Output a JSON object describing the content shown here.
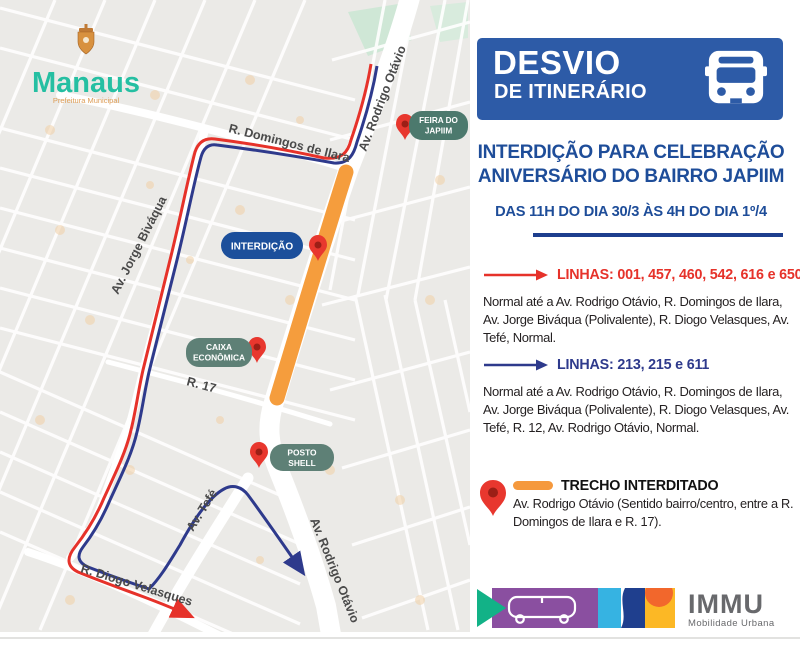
{
  "map": {
    "logo": {
      "title": "Manaus",
      "subtitle": "Prefeitura Municipal"
    },
    "streets": {
      "domingos": "R. Domingos de Ilara",
      "rodrigo_top": "Av. Rodrigo Otávio",
      "rodrigo_bottom": "Av. Rodrigo Otávio",
      "jorge": "Av. Jorge Biváqua",
      "r17": "R. 17",
      "tefe": "Av. Tefé",
      "diogo": "R. Diogo Velasques"
    },
    "badges": {
      "feira": {
        "line1": "FEIRA DO",
        "line2": "JAPIIM"
      },
      "interdicao": {
        "line1": "INTERDIÇÃO"
      },
      "caixa": {
        "line1": "CAIXA",
        "line2": "ECONÔMICA"
      },
      "posto": {
        "line1": "POSTO",
        "line2": "SHELL"
      }
    },
    "icons": {
      "pin": "map-pin-icon"
    }
  },
  "panel": {
    "header": {
      "title": "DESVIO",
      "subtitle": "DE ITINERÁRIO",
      "icon": "bus-front-icon"
    },
    "headline": {
      "line1": "INTERDIÇÃO PARA CELEBRAÇÃO",
      "line2": "ANIVERSÁRIO DO BAIRRO JAPIIM"
    },
    "schedule": "DAS 11H DO DIA 30/3 ÀS 4H DO DIA 1º/4",
    "routes": [
      {
        "label": "LINHAS: 001, 457, 460, 542, 616 e 650",
        "description": "Normal até a Av. Rodrigo Otávio, R. Domingos de Ilara, Av. Jorge Biváqua (Polivalente), R. Diogo Velasques, Av. Tefé, Normal.",
        "color": "#e6322a"
      },
      {
        "label": "LINHAS:  213, 215 e 611",
        "description": "Normal até a Av. Rodrigo Otávio, R. Domingos de Ilara, Av. Jorge Biváqua (Polivalente), R. Diogo Velasques, Av. Tefé, R. 12, Av. Rodrigo Otávio, Normal.",
        "color": "#2e3a8c"
      }
    ],
    "blocked": {
      "title": "TRECHO INTERDITADO",
      "description": "Av. Rodrigo Otávio (Sentido bairro/centro, entre a R. Domingos de Ilara e R. 17)."
    },
    "footer": {
      "brand": "IMMU",
      "tagline": "Mobilidade Urbana",
      "icon": "bus-side-icon"
    }
  },
  "colors": {
    "header_blue": "#2d5ba7",
    "headline_blue": "#1e4d99",
    "divider_navy": "#1d3e8e",
    "route_red": "#e6322a",
    "route_blue": "#2e3a8c",
    "blocked_orange": "#f5993d",
    "badge_teal": "#5e8076",
    "badge_dark_teal": "#4c796d",
    "badge_blue": "#1c4f9b",
    "pin_red": "#e8372e",
    "map_bg": "#ebeae7",
    "immu_gray": "#68696c",
    "logo_teal": "#25bfa2"
  }
}
